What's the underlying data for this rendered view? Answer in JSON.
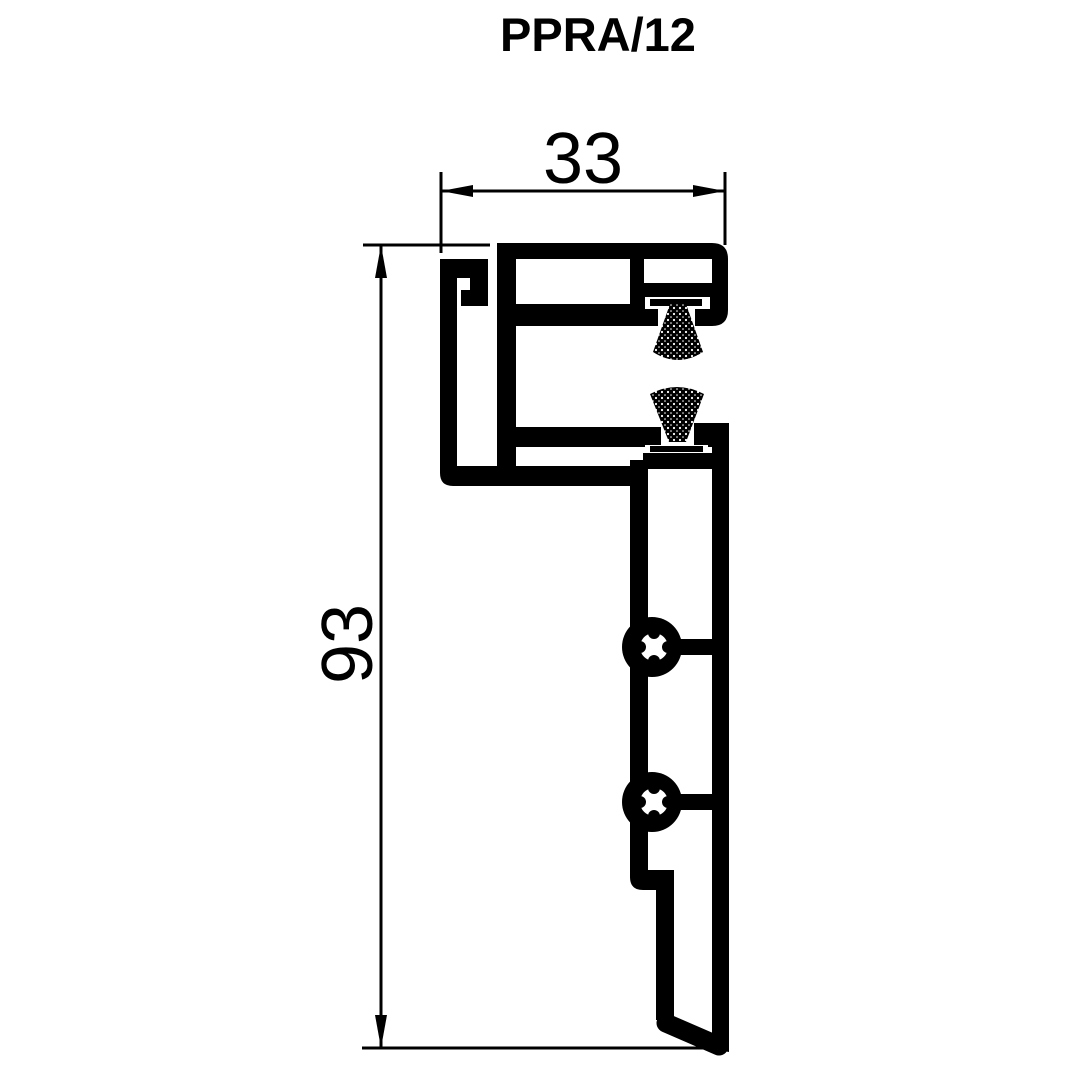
{
  "title": "PPRA/12",
  "dimensions": {
    "width": {
      "value": "33",
      "orientation": "horizontal"
    },
    "height": {
      "value": "93",
      "orientation": "vertical"
    }
  },
  "figure": {
    "kind": "profile-cross-section",
    "parts": [
      "top-channel-with-chambers",
      "left-hook",
      "upper-brush-seal",
      "lower-brush-seal",
      "screw-boss",
      "screw-boss",
      "bottom-fin"
    ]
  },
  "colors": {
    "ink": "#000000",
    "background": "#ffffff"
  }
}
